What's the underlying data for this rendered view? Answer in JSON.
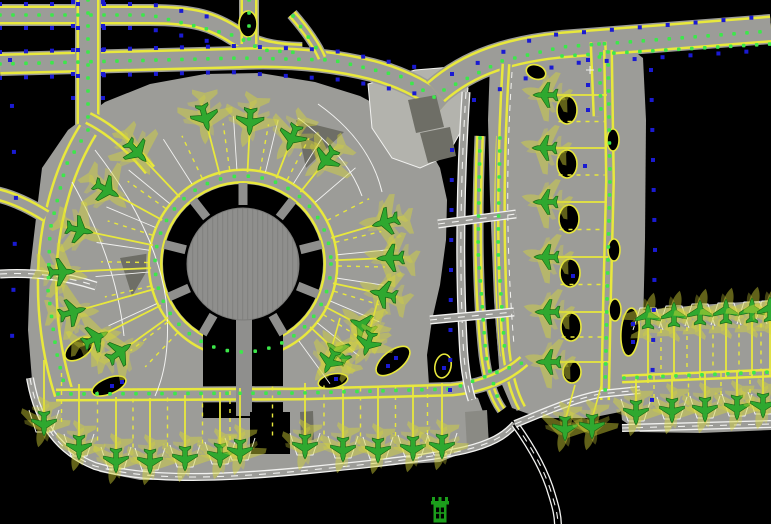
{
  "canvas": {
    "width": 771,
    "height": 524,
    "description": "airport terminal apron CAD plan"
  },
  "colors": {
    "background": "#000000",
    "pavement": "#9c9c98",
    "pavement_light": "#b3b3ad",
    "building_dark": "#6e6e66",
    "building_mid": "#8a8a84",
    "concourse": "#8f8f8d",
    "taxi_yellow": "#e8e83c",
    "centerline_green": "#3ce84a",
    "edge_blue": "#1a1ad2",
    "marking_white": "#f2f2f0",
    "aircraft_green": "#2fa82f",
    "aircraft_outline": "#156015",
    "aircraft_ghost": "#d8d838",
    "tower_green": "#1b9e1b"
  },
  "glyphs": {
    "plane": "M0,-12 C1.8,-9.5 2.4,-7 2.4,-4 L12.5,2.5 L12.5,5 L2.4,3 L2.4,8 L5.8,11 L5.8,13 L0,11.4 L-5.8,13 L-5.8,11 L-2.4,8 L-2.4,3 L-12.5,5 L-12.5,2.5 L-2.4,-4 C-2.4,-7 -1.8,-9.5 0,-12 Z"
  },
  "pavements": [
    {
      "name": "main-apron",
      "fill": "pavement",
      "d": "M36,218 L42,168 L68,130 L105,102 L150,84 L205,74 L260,73 L315,82 L360,96 L398,116 L424,140 L440,168 L447,200 L446,240 L440,285 L432,320 L427,355 L429,385 L455,390 L478,398 L486,420 L484,438 L470,450 L440,462 L390,465 L330,471 L270,475 L200,480 L140,480 L100,472 L68,452 L45,420 L32,380 L28,330 L30,270 Z"
    },
    {
      "name": "right-strip",
      "fill": "pavement",
      "d": "M490,62 L630,48 L643,58 L646,120 L645,240 L643,330 L638,395 L620,412 L590,418 L540,418 L512,408 L500,380 L494,300 L490,200 L488,120 Z"
    },
    {
      "name": "southeast-apron",
      "fill": "pavement",
      "d": "M622,312 L700,305 L771,300 L771,430 L700,433 L640,432 L622,420 L618,380 L618,340 Z"
    },
    {
      "name": "landside-area",
      "fill": "pavement_light",
      "stroke": "marking_white",
      "d": "M368,84 L415,70 L452,67 L468,88 L464,126 L447,156 L420,168 L392,158 L372,128 Z"
    }
  ],
  "bands": [
    {
      "name": "taxiway-top-a",
      "d": "M0,15 L150,15 C195,15 213,21 236,36 C255,48 270,52 302,53",
      "w": 22
    },
    {
      "name": "taxiway-top-b",
      "d": "M0,64 L240,58 C290,56 332,60 372,70 C402,78 426,90 444,106",
      "w": 24
    },
    {
      "name": "taxiway-top-stub",
      "d": "M249,-4 L249,44",
      "w": 20
    },
    {
      "name": "taxiway-top-connector",
      "d": "M292,14 C306,30 316,44 322,58",
      "w": 12
    },
    {
      "name": "taxiway-left-vertical",
      "d": "M88,-4 L88,130",
      "w": 26
    },
    {
      "name": "taxiway-west-perimeter",
      "d": "M88,130 C66,165 52,210 48,258 C45,305 50,350 64,394",
      "w": 24
    },
    {
      "name": "taxiway-nw-fan",
      "d": "M88,118 C112,130 132,148 150,170",
      "w": 16
    },
    {
      "name": "taxiway-left-spur",
      "d": "M-4,194 C14,198 30,206 46,216",
      "w": 16
    },
    {
      "name": "taxiway-topright-main",
      "d": "M436,92 C470,62 512,50 562,45 L771,29",
      "w": 30
    },
    {
      "name": "taxiway-topright-spur",
      "d": "M598,42 L601,116",
      "w": 20
    },
    {
      "name": "taxiway-gap-twin-a",
      "d": "M480,136 C477,210 477,290 484,355 C487,378 492,396 502,410",
      "w": 11
    },
    {
      "name": "taxiway-gap-twin-b",
      "d": "M500,136 C497,210 497,290 504,356",
      "w": 11
    },
    {
      "name": "taxiway-strip-left",
      "d": "M506,64 C500,160 500,260 506,350 C509,376 514,394 522,408",
      "w": 12
    },
    {
      "name": "taxiway-strip-right",
      "d": "M608,50 L610,180 L607,300 L605,400",
      "w": 13
    },
    {
      "name": "taxiway-se-lane",
      "d": "M622,379 L771,373",
      "w": 12
    }
  ],
  "corridor_band": {
    "name": "taxilane-south-corridor",
    "d": "M56,395 L300,394 L452,390 C482,387 506,377 524,361",
    "w": 16
  },
  "buildings": [
    {
      "name": "landside-building-a",
      "fill": "building_dark",
      "d": "M408,100 L436,95 L444,127 L416,133 Z"
    },
    {
      "name": "landside-building-b",
      "fill": "building_dark",
      "d": "M420,133 L450,127 L456,156 L428,163 Z"
    },
    {
      "name": "apron-structure-ne",
      "fill": "building_dark",
      "d": "M296,120 L344,132 L306,168 Z"
    },
    {
      "name": "apron-structure-w",
      "fill": "building_dark",
      "d": "M120,258 L158,252 L132,296 Z"
    },
    {
      "name": "se-parking-structure",
      "fill": "building_mid",
      "d": "M465,412 L487,410 L489,446 L467,448 Z"
    },
    {
      "name": "south-slab",
      "fill": "building_dark",
      "d": "M300,412 L313,411 L314,440 L301,441 Z"
    }
  ],
  "terminal": {
    "cx": 243,
    "cy": 264,
    "keyhole_r": 80,
    "stem": {
      "x": 203,
      "w": 80,
      "y_top": 300,
      "y_bot": 418
    },
    "concourse_r": 56,
    "stub_angles": [
      14,
      52,
      90,
      128,
      166,
      204,
      240,
      300,
      338
    ],
    "stub_r": 63,
    "stub_len": 18,
    "stub_w": 9,
    "pier": {
      "x": 236,
      "y": 316,
      "w": 16,
      "h": 100
    },
    "ring_band": {
      "r": 88,
      "w": 18
    },
    "south_building": {
      "x": 250,
      "y": 412,
      "w": 40,
      "h": 42
    }
  },
  "islands": [
    {
      "cx": 248,
      "cy": 24,
      "rx": 9,
      "ry": 13,
      "rot": 0,
      "blue": false
    },
    {
      "cx": 79,
      "cy": 349,
      "rx": 16,
      "ry": 9,
      "rot": -35,
      "blue": false
    },
    {
      "cx": 109,
      "cy": 386,
      "rx": 18,
      "ry": 8,
      "rot": -22,
      "blue": true
    },
    {
      "cx": 393,
      "cy": 361,
      "rx": 20,
      "ry": 10,
      "rot": -38,
      "blue": true
    },
    {
      "cx": 333,
      "cy": 381,
      "rx": 15,
      "ry": 7,
      "rot": -12,
      "blue": true
    },
    {
      "cx": 443,
      "cy": 366,
      "rx": 8,
      "ry": 12,
      "rot": 12,
      "blue": true
    },
    {
      "cx": 536,
      "cy": 72,
      "rx": 10,
      "ry": 7,
      "rot": 20,
      "blue": false
    },
    {
      "cx": 567,
      "cy": 110,
      "rx": 10,
      "ry": 14,
      "rot": 0,
      "blue": false
    },
    {
      "cx": 567,
      "cy": 164,
      "rx": 10,
      "ry": 14,
      "rot": 0,
      "blue": true
    },
    {
      "cx": 569,
      "cy": 219,
      "rx": 10,
      "ry": 14,
      "rot": 0,
      "blue": false
    },
    {
      "cx": 570,
      "cy": 273,
      "rx": 10,
      "ry": 14,
      "rot": 0,
      "blue": true
    },
    {
      "cx": 571,
      "cy": 327,
      "rx": 10,
      "ry": 14,
      "rot": 0,
      "blue": false
    },
    {
      "cx": 572,
      "cy": 372,
      "rx": 9,
      "ry": 11,
      "rot": 0,
      "blue": false
    },
    {
      "cx": 613,
      "cy": 140,
      "rx": 6,
      "ry": 11,
      "rot": 0,
      "blue": false
    },
    {
      "cx": 614,
      "cy": 250,
      "rx": 6,
      "ry": 11,
      "rot": 0,
      "blue": false
    },
    {
      "cx": 615,
      "cy": 310,
      "rx": 6,
      "ry": 11,
      "rot": 0,
      "blue": false
    },
    {
      "cx": 630,
      "cy": 332,
      "rx": 9,
      "ry": 24,
      "rot": 4,
      "blue": true
    }
  ],
  "roads": [
    {
      "name": "service-road-vertical",
      "d": "M466,92 C461,170 459,260 463,340 C464,365 467,385 472,400",
      "w": 9,
      "inner": "pavement"
    },
    {
      "name": "crossing-road-north",
      "d": "M438,224 L516,214",
      "w": 9,
      "inner": "pavement"
    },
    {
      "name": "crossing-road-south",
      "d": "M430,320 L514,312",
      "w": 9,
      "inner": "pavement"
    },
    {
      "name": "west-access-road",
      "d": "M0,274 C35,272 65,276 96,286",
      "w": 9,
      "inner": "pavement"
    },
    {
      "name": "south-boundary-road",
      "d": "M30,378 C38,425 60,452 95,466 C150,482 230,478 310,470 C370,464 430,458 465,450 C490,444 505,436 515,424",
      "w": 8,
      "inner": "pavement"
    },
    {
      "name": "south-exit-road",
      "d": "M515,424 C530,445 545,470 552,495 C556,508 558,516 558,526",
      "w": 8,
      "inner": "background"
    },
    {
      "name": "east-link-road",
      "d": "M515,424 C540,414 570,400 600,394 L640,390",
      "w": 8,
      "inner": "pavement"
    },
    {
      "name": "se-apron-road",
      "d": "M622,428 L771,424",
      "w": 8,
      "inner": "pavement"
    }
  ],
  "white_lines": [
    {
      "name": "apron-marking-arc-a",
      "d": "M95,150 C130,195 158,245 166,300 C170,340 166,372 155,396"
    },
    {
      "name": "apron-marking-arc-b",
      "d": "M72,182 C100,232 118,280 124,336"
    },
    {
      "name": "ne-marking-curve-a",
      "d": "M298,118 C330,142 352,168 362,196"
    },
    {
      "name": "ne-marking-curve-b",
      "d": "M318,104 C352,128 374,158 382,192"
    },
    {
      "name": "strip-marking-dashed",
      "d": "M512,72 C506,160 506,250 514,345",
      "dash": "6 5"
    }
  ],
  "green_dot_rows": [
    {
      "pts": [
        [
          0,
          15
        ],
        [
          150,
          15
        ],
        [
          236,
          36
        ],
        [
          262,
          50
        ],
        [
          302,
          53
        ]
      ]
    },
    {
      "pts": [
        [
          0,
          64
        ],
        [
          240,
          58
        ],
        [
          332,
          60
        ],
        [
          400,
          76
        ],
        [
          442,
          102
        ]
      ]
    },
    {
      "pts": [
        [
          249,
          0
        ],
        [
          249,
          44
        ]
      ]
    },
    {
      "pts": [
        [
          293,
          16
        ],
        [
          322,
          56
        ]
      ]
    },
    {
      "pts": [
        [
          88,
          0
        ],
        [
          88,
          130
        ],
        [
          66,
          165
        ],
        [
          50,
          230
        ],
        [
          48,
          290
        ],
        [
          56,
          350
        ],
        [
          66,
          392
        ]
      ]
    },
    {
      "pts": [
        [
          444,
          90
        ],
        [
          502,
          61
        ],
        [
          562,
          47
        ],
        [
          771,
          31
        ]
      ]
    },
    {
      "pts": [
        [
          562,
          56
        ],
        [
          771,
          44
        ]
      ]
    },
    {
      "pts": [
        [
          599,
          44
        ],
        [
          601,
          114
        ]
      ]
    },
    {
      "pts": [
        [
          480,
          138
        ],
        [
          478,
          250
        ],
        [
          486,
          358
        ],
        [
          500,
          406
        ]
      ]
    },
    {
      "pts": [
        [
          500,
          138
        ],
        [
          498,
          250
        ],
        [
          505,
          354
        ]
      ]
    },
    {
      "pts": [
        [
          608,
          52
        ],
        [
          610,
          180
        ],
        [
          607,
          300
        ],
        [
          605,
          398
        ]
      ]
    },
    {
      "pts": [
        [
          58,
          394
        ],
        [
          300,
          393
        ],
        [
          452,
          389
        ],
        [
          522,
          363
        ]
      ]
    },
    {
      "pts": [
        [
          624,
          378
        ],
        [
          771,
          372
        ]
      ]
    }
  ],
  "green_dot_circles": [
    {
      "cx": 243,
      "cy": 264,
      "r": 88,
      "gap": 14
    }
  ],
  "blue_rows": [
    {
      "pts": [
        [
          0,
          4
        ],
        [
          150,
          4
        ],
        [
          232,
          22
        ]
      ],
      "gap": 26
    },
    {
      "pts": [
        [
          0,
          28
        ],
        [
          145,
          28
        ],
        [
          222,
          44
        ]
      ],
      "gap": 26
    },
    {
      "pts": [
        [
          0,
          52
        ],
        [
          235,
          46
        ],
        [
          330,
          50
        ],
        [
          420,
          68
        ]
      ],
      "gap": 26
    },
    {
      "pts": [
        [
          0,
          78
        ],
        [
          230,
          72
        ],
        [
          345,
          80
        ],
        [
          428,
          96
        ]
      ],
      "gap": 26
    },
    {
      "pts": [
        [
          73,
          2
        ],
        [
          73,
          115
        ]
      ],
      "gap": 24
    },
    {
      "pts": [
        [
          103,
          2
        ],
        [
          103,
          110
        ]
      ],
      "gap": 24
    },
    {
      "pts": [
        [
          452,
          74
        ],
        [
          540,
          36
        ],
        [
          771,
          16
        ]
      ],
      "gap": 28
    },
    {
      "pts": [
        [
          474,
          100
        ],
        [
          560,
          64
        ],
        [
          771,
          50
        ]
      ],
      "gap": 28
    },
    {
      "pts": [
        [
          452,
          150
        ],
        [
          450,
          390
        ]
      ],
      "gap": 30
    },
    {
      "pts": [
        [
          651,
          70
        ],
        [
          655,
          250
        ],
        [
          652,
          400
        ]
      ],
      "gap": 30
    },
    {
      "pts": [
        [
          10,
          60
        ],
        [
          16,
          200
        ],
        [
          12,
          340
        ]
      ],
      "gap": 46
    },
    {
      "pts": [
        [
          588,
          60
        ],
        [
          588,
          110
        ]
      ],
      "gap": 25
    }
  ],
  "blue_singles": [
    [
      585,
      166
    ],
    [
      573,
      276
    ],
    [
      112,
      386
    ],
    [
      122,
      382
    ],
    [
      396,
      358
    ],
    [
      388,
      366
    ],
    [
      336,
      379
    ],
    [
      444,
      368
    ],
    [
      633,
      324
    ],
    [
      633,
      342
    ]
  ],
  "aircraft": {
    "ring": {
      "center": [
        243,
        264
      ],
      "lead_r_in": 92,
      "lead_r_out": 150,
      "scale": 1.1,
      "positions": [
        [
          137,
          152
        ],
        [
          107,
          190
        ],
        [
          80,
          230
        ],
        [
          62,
          272
        ],
        [
          73,
          312
        ],
        [
          96,
          338
        ],
        [
          120,
          352
        ],
        [
          205,
          118
        ],
        [
          250,
          122
        ],
        [
          292,
          138
        ],
        [
          326,
          160
        ],
        [
          385,
          222
        ],
        [
          390,
          258
        ],
        [
          383,
          294
        ],
        [
          362,
          326
        ],
        [
          337,
          352
        ]
      ]
    },
    "rows": [
      {
        "name": "south-stand-row",
        "pts": [
          [
            44,
            424
          ],
          [
            79,
            448
          ],
          [
            116,
            461
          ],
          [
            150,
            462
          ],
          [
            185,
            459
          ],
          [
            220,
            456
          ],
          [
            240,
            452
          ],
          [
            305,
            447
          ],
          [
            343,
            450
          ],
          [
            378,
            451
          ],
          [
            413,
            449
          ],
          [
            442,
            447
          ]
        ],
        "rot": 180,
        "lead": {
          "dx": 0,
          "dy": -1,
          "len": 56,
          "from": 8
        },
        "dashed_len": 50,
        "stand": true
      },
      {
        "name": "east-strip-row",
        "pts": [
          [
            545,
            95
          ],
          [
            544,
            148
          ],
          [
            545,
            202
          ],
          [
            546,
            257
          ],
          [
            547,
            312
          ],
          [
            548,
            362
          ]
        ],
        "rot": 270,
        "lead": {
          "dx": 1,
          "dy": 0,
          "len": 52,
          "from": 10
        },
        "dashed_len": 46,
        "stand": false
      },
      {
        "name": "se-apron-north-row",
        "pts": [
          [
            648,
            316
          ],
          [
            674,
            314
          ],
          [
            700,
            312
          ],
          [
            726,
            311
          ],
          [
            752,
            310
          ],
          [
            770,
            309
          ]
        ],
        "rot": 0,
        "lead": {
          "dx": 0,
          "dy": 1,
          "len": 58,
          "from": 9
        },
        "dashed_len": 48,
        "stand": true
      },
      {
        "name": "se-apron-south-row",
        "pts": [
          [
            636,
            413
          ],
          [
            672,
            411
          ],
          [
            705,
            410
          ],
          [
            737,
            408
          ],
          [
            763,
            406
          ]
        ],
        "rot": 180,
        "lead": {
          "dx": 0,
          "dy": -1,
          "len": 28,
          "from": 9
        },
        "dashed_len": 24,
        "stand": true
      }
    ],
    "singles": [
      {
        "x": 565,
        "y": 429,
        "rot": 180
      },
      {
        "x": 592,
        "y": 427,
        "rot": 180
      },
      {
        "x": 330,
        "y": 362,
        "rot": 205
      },
      {
        "x": 368,
        "y": 344,
        "rot": 198
      }
    ]
  },
  "tower": {
    "x": 440,
    "y": 500
  },
  "crosshair": {
    "x": 590,
    "y": 70
  }
}
